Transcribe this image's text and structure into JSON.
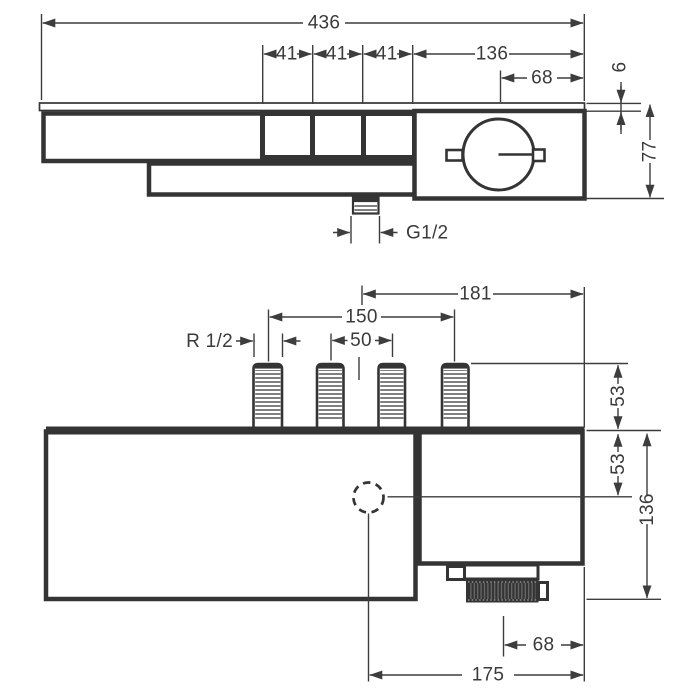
{
  "drawing_title": "thermostat-dimensional-drawing",
  "colors": {
    "line": "#343434",
    "dim": "#3d3d3d",
    "background": "#ffffff"
  },
  "front_view": {
    "dims": {
      "total_width": "436",
      "segment_1": "41",
      "segment_2": "41",
      "segment_3": "41",
      "thermostat_block_width": "136",
      "handle_center_offset": "68",
      "panel_thickness": "6",
      "body_height": "77",
      "outlet_thread": "G1/2"
    }
  },
  "plan_view": {
    "dims": {
      "outlet_to_right_edge_upper": "181",
      "connection_span": "150",
      "connection_pitch": "50",
      "connection_thread": "R 1/2",
      "connector_length": "53",
      "outlet_depth": "53",
      "total_depth": "136",
      "knob_center_offset": "68",
      "outlet_center_offset": "175"
    }
  }
}
